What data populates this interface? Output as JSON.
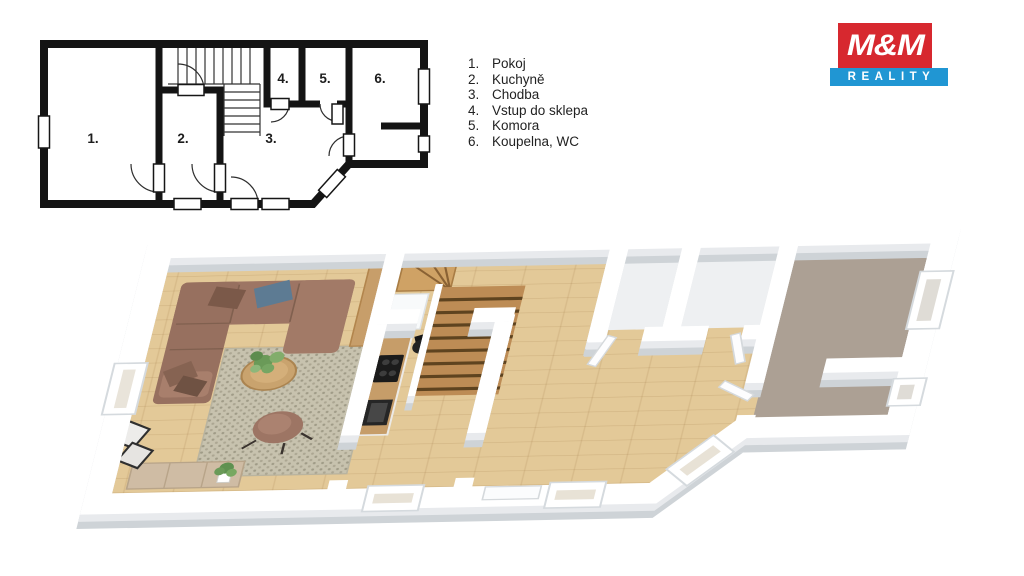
{
  "page": {
    "width": 1024,
    "height": 576,
    "background": "#ffffff"
  },
  "logo": {
    "line1": "M&M",
    "line2": "REALITY",
    "red": "#d7282f",
    "blue": "#2096d3",
    "text_color": "#ffffff"
  },
  "legend": {
    "items": [
      {
        "num": "1.",
        "label": "Pokoj"
      },
      {
        "num": "2.",
        "label": "Kuchyně"
      },
      {
        "num": "3.",
        "label": "Chodba"
      },
      {
        "num": "4.",
        "label": "Vstup do sklepa"
      },
      {
        "num": "5.",
        "label": "Komora"
      },
      {
        "num": "6.",
        "label": "Koupelna, WC"
      }
    ]
  },
  "plan2d": {
    "room_labels": [
      "1.",
      "2.",
      "3.",
      "4.",
      "5.",
      "6."
    ],
    "wall_color": "#141414"
  },
  "plan3d": {
    "colors": {
      "wall_top": "#ffffff",
      "wall_face": "#ced3d7",
      "oak_floor": "#e3c998",
      "stair_wood": "#bd8c55",
      "winder_wood": "#cfa265",
      "room6_floor": "#aca094",
      "rooms45_floor": "#eef0f2",
      "rug": "#c7c2ae",
      "sofa": "#9d7564",
      "counter_wood": "#c69d69"
    }
  }
}
